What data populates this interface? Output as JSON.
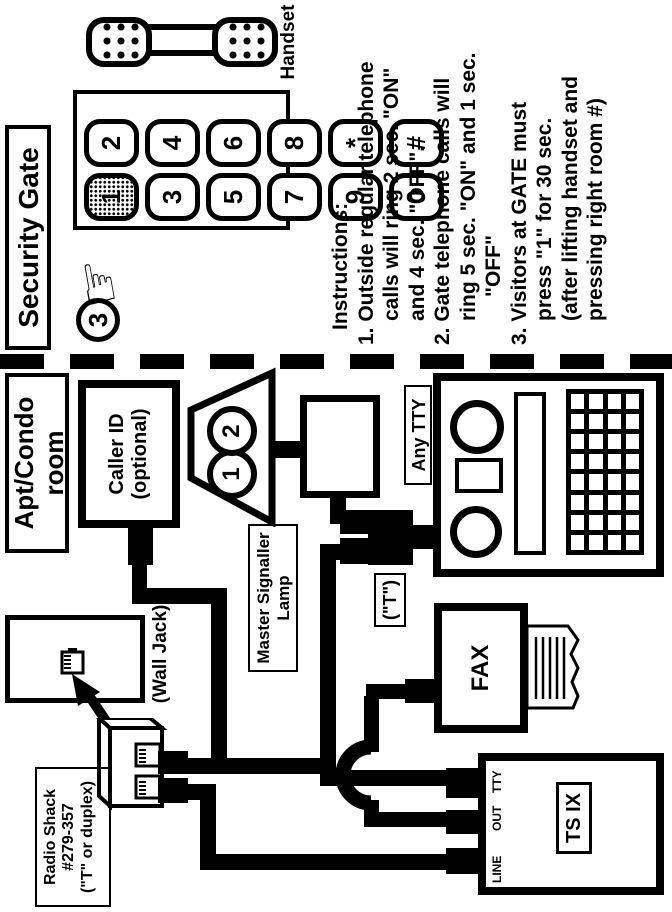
{
  "security_section": {
    "title": "Security Gate",
    "handset_label": "Handset",
    "circled_number": "3",
    "hand_glyph": "☞",
    "keys": [
      "1",
      "2",
      "3",
      "4",
      "5",
      "6",
      "7",
      "8",
      "9",
      "*",
      "0",
      "#"
    ],
    "instructions": {
      "heading": "Instructions:",
      "lines": [
        {
          "text": "1. Outside regular telephone"
        },
        {
          "text": "calls will ring 2 sec. \"ON\""
        },
        {
          "text": "and 4 sec. \"OFF\"."
        },
        {
          "text": "2. Gate telephone calls will"
        },
        {
          "text": "ring 5 sec. \"ON\" and 1 sec."
        },
        {
          "text": "\"OFF\""
        },
        {
          "text": "3. Visitors at GATE must"
        },
        {
          "text": "press \"1\" for 30 sec."
        },
        {
          "text": "(after lifting handset and"
        },
        {
          "text": "pressing right room #)"
        }
      ]
    }
  },
  "room_section": {
    "title_line1": "Apt/Condo",
    "title_line2": "room",
    "caller_id_line1": "Caller ID",
    "caller_id_line2": "(optional)",
    "bell_circle_1": "1",
    "bell_circle_2": "2",
    "master_signaller_line1": "Master Signaller",
    "master_signaller_line2": "Lamp",
    "any_tty_label": "Any TTY",
    "t_adapter_label": "(\"T\")",
    "fax_label": "FAX",
    "tsix": {
      "port_line": "LINE",
      "port_out": "OUT",
      "port_tty": "TTY",
      "model": "TS IX"
    },
    "wall_jack_label": "(Wall Jack)",
    "radio_shack_line1": "Radio Shack",
    "radio_shack_line2": "#279-357",
    "radio_shack_line3": "(\"T\" or duplex)"
  },
  "colors": {
    "ink": "#000000",
    "paper": "#ffffff"
  }
}
